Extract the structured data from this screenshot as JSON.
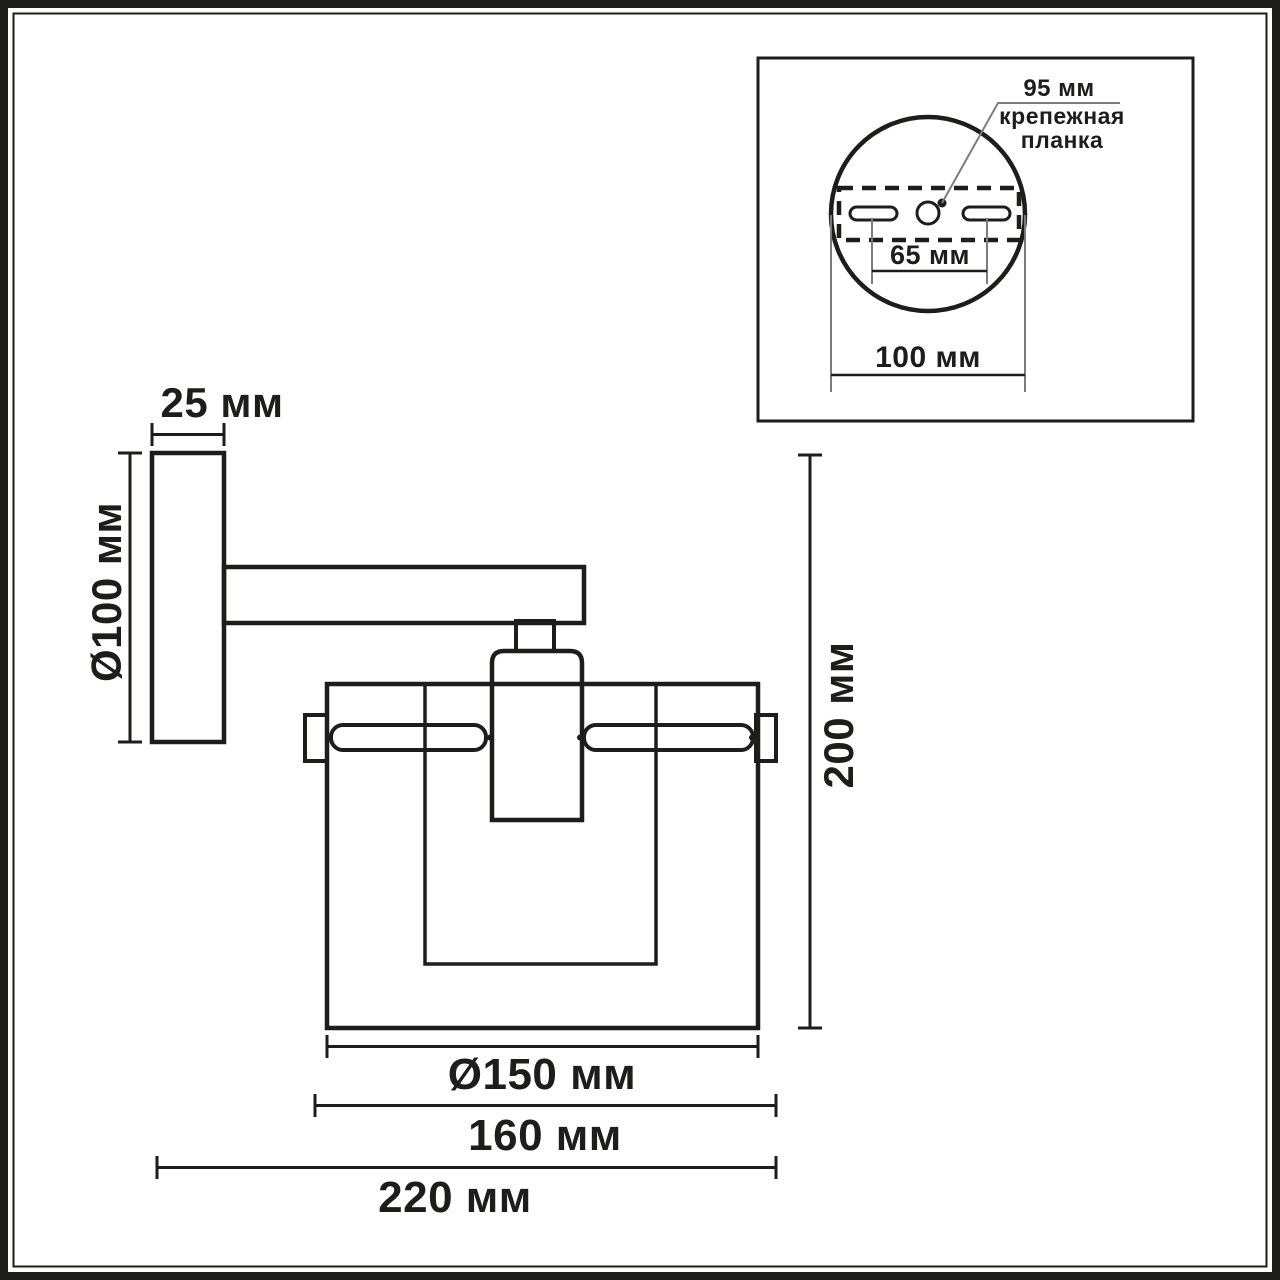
{
  "colors": {
    "line": "#1d1d1b",
    "leader": "#7c7c7c",
    "background": "#ffffff"
  },
  "main_view": {
    "dimensions": {
      "plate_thickness": "25 мм",
      "plate_diameter": "Ø100 мм",
      "overall_height": "200 мм",
      "shade_diameter": "Ø150 мм",
      "width_with_rods": "160 мм",
      "overall_depth": "220 мм"
    }
  },
  "inset_view": {
    "bracket_offset": "95 мм",
    "bracket_label_line1": "крепежная",
    "bracket_label_line2": "планка",
    "slot_spacing": "65 мм",
    "base_diameter": "100 мм"
  }
}
